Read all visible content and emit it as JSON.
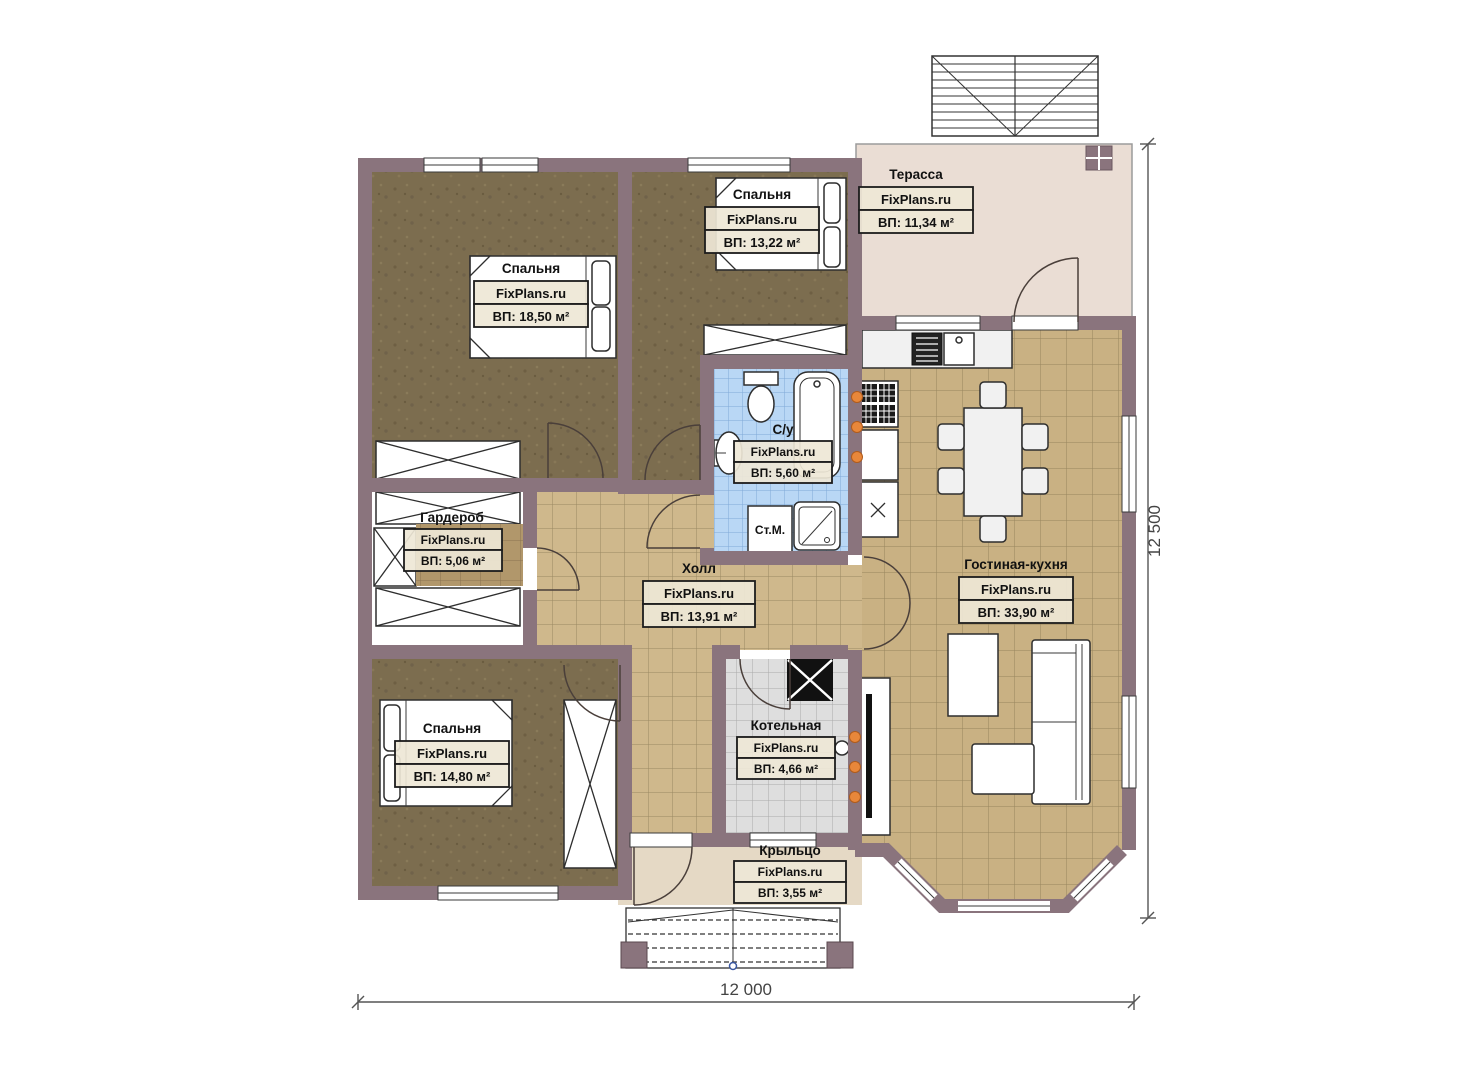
{
  "watermark": "FixPlans.ru",
  "rooms": [
    {
      "id": "bedroom-1",
      "name": "Спальня",
      "area": "ВП: 18,50 м²"
    },
    {
      "id": "bedroom-2",
      "name": "Спальня",
      "area": "ВП: 13,22 м²"
    },
    {
      "id": "terrace",
      "name": "Терасса",
      "area": "ВП: 11,34 м²"
    },
    {
      "id": "bathroom",
      "name": "С/у",
      "area": "ВП: 5,60 м²"
    },
    {
      "id": "wardrobe",
      "name": "Гардероб",
      "area": "ВП: 5,06 м²"
    },
    {
      "id": "hall",
      "name": "Холл",
      "area": "ВП: 13,91 м²"
    },
    {
      "id": "living-kitchen",
      "name": "Гостиная-кухня",
      "area": "ВП: 33,90 м²"
    },
    {
      "id": "bedroom-3",
      "name": "Спальня",
      "area": "ВП: 14,80 м²"
    },
    {
      "id": "boiler-room",
      "name": "Котельная",
      "area": "ВП: 4,66 м²"
    },
    {
      "id": "porch",
      "name": "Крыльцо",
      "area": "ВП: 3,55 м²"
    }
  ],
  "labels": {
    "washing_machine": "Ст.М."
  },
  "dimensions": {
    "width": "12 000",
    "height": "12 500"
  },
  "colors": {
    "wall": "#8a747d",
    "bedroom_floor": "#7c6d4f",
    "hall_tile": "#cfb88c",
    "living_tile": "#c9b183",
    "wardrobe_tile": "#b1976b",
    "bathroom_tile": "#b9d7f5",
    "boiler_tile": "#dedede",
    "terrace_floor": "#eaddd4",
    "porch_floor": "#e5d9c5",
    "accent": "#e8873a"
  }
}
